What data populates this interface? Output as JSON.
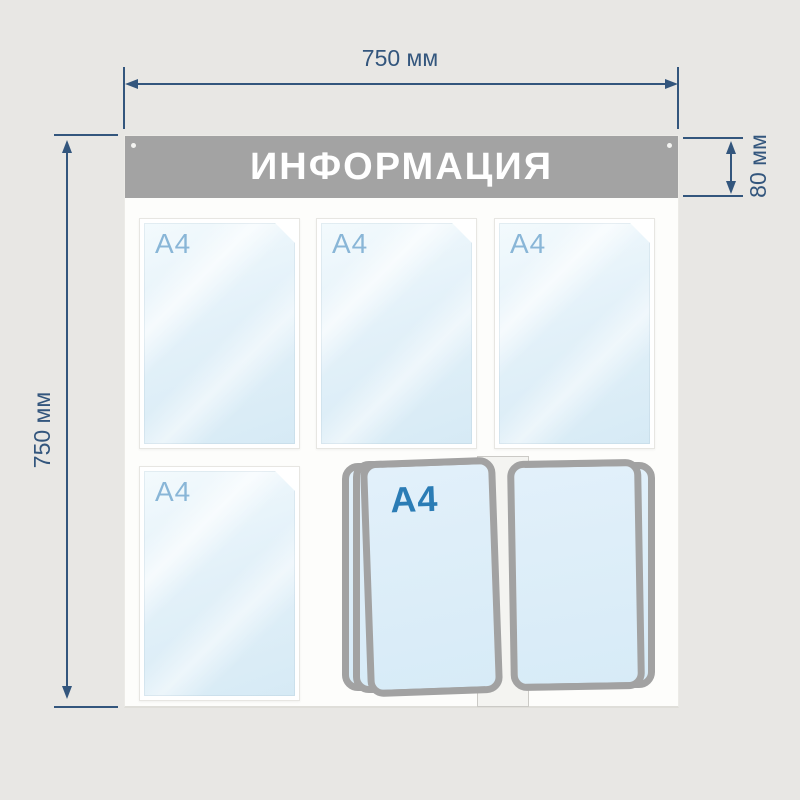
{
  "board": {
    "header": {
      "title": "ИНФОРМАЦИЯ"
    },
    "pockets": [
      {
        "label": "A4"
      },
      {
        "label": "A4"
      },
      {
        "label": "A4"
      },
      {
        "label": "A4"
      }
    ],
    "flip_system": {
      "label": "A4"
    }
  },
  "dimensions": {
    "width": "750 мм",
    "height": "750 мм",
    "header_height": "80 мм"
  },
  "colors": {
    "background": "#e8e7e4",
    "dimension_line": "#33567d",
    "header_gray": "#a3a3a3",
    "board_white": "#fdfdfb",
    "pocket_fill": "#ddeef8",
    "pocket_label": "#89b6d7",
    "flip_label": "#2b7cb5",
    "frame_gray": "#a2a2a2"
  }
}
